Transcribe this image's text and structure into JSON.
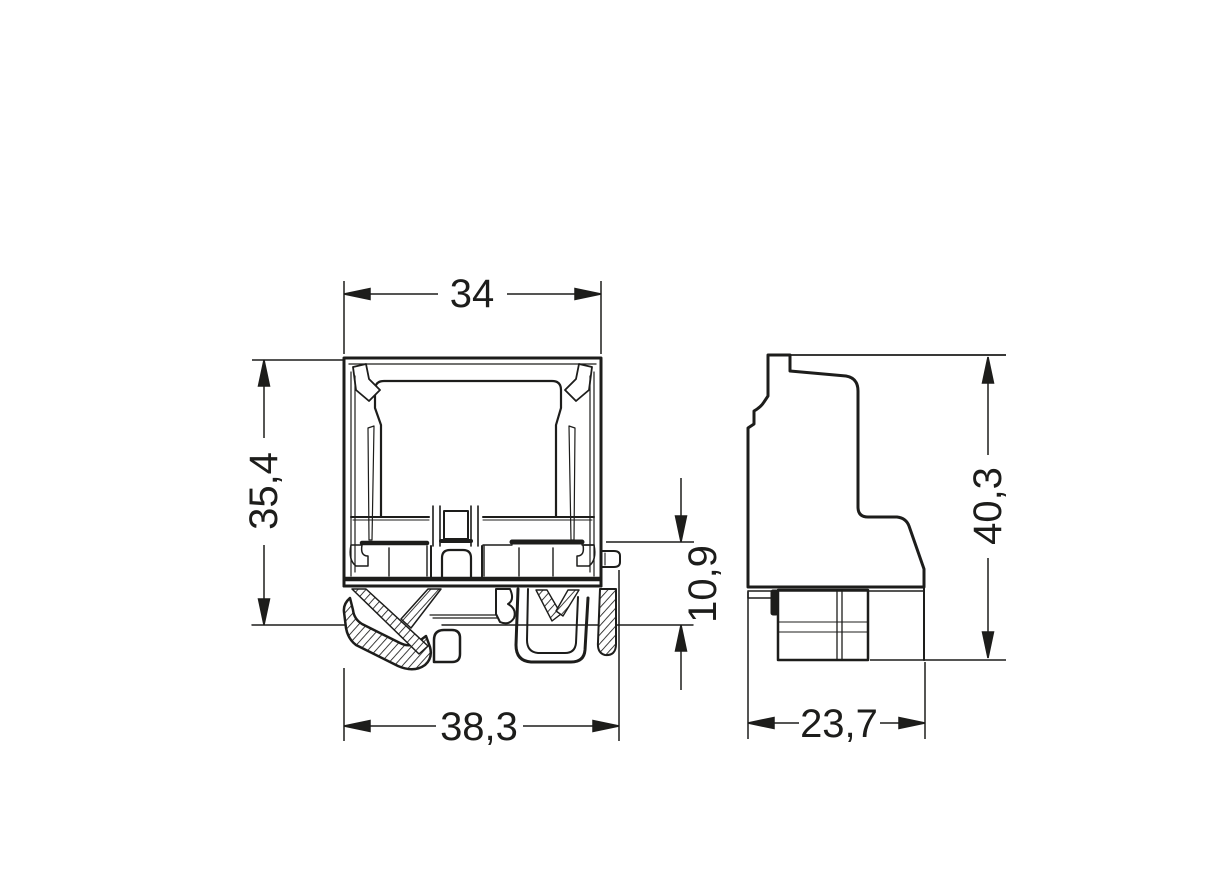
{
  "page": {
    "background_color": "#ffffff",
    "line_color": "#1d1d1b"
  },
  "drawing": {
    "type": "technical-dimension-drawing",
    "views": {
      "front": {
        "label": "front-view-of-terminal-block"
      },
      "side": {
        "label": "side-view-of-terminal-block"
      }
    }
  },
  "dimensions": {
    "front_width_top": "34",
    "front_height": "35,4",
    "rail_offset": "10,9",
    "front_width_bottom": "38,3",
    "side_depth": "23,7",
    "side_height": "40,3"
  }
}
